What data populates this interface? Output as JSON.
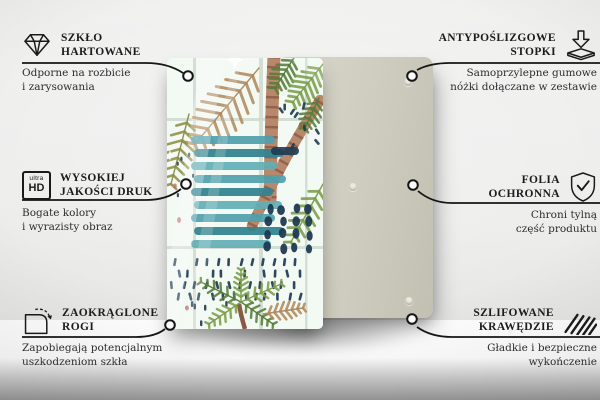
{
  "page": {
    "type": "product-feature-infographic",
    "language": "pl"
  },
  "product": {
    "front_panel": "glass board with tropical watercolor print (palms, teal stripes, navy dots)",
    "back_panel": "plain rear panel with self-adhesive feet"
  },
  "features": [
    {
      "id": "tempered-glass",
      "icon": "diamond-icon",
      "side": "top-left",
      "title_lines": [
        "SZKŁO",
        "HARTOWANE"
      ],
      "desc_lines": [
        "Odporne na rozbicie",
        "i zarysowania"
      ]
    },
    {
      "id": "anti-slip-feet",
      "icon": "adhesive-feet-icon",
      "side": "top-right",
      "title_lines": [
        "ANTYPOŚLIZGOWE",
        "STOPKI"
      ],
      "desc_lines": [
        "Samoprzylepne gumowe",
        "nóżki dołączane w zestawie"
      ]
    },
    {
      "id": "high-quality-print",
      "icon": "ultra-hd-icon",
      "side": "middle-left",
      "icon_label_top": "ultra",
      "icon_label_bottom": "HD",
      "title_lines": [
        "WYSOKIEJ",
        "JAKOŚCI DRUK"
      ],
      "desc_lines": [
        "Bogate kolory",
        "i wyrazisty obraz"
      ]
    },
    {
      "id": "protective-film",
      "icon": "shield-check-icon",
      "side": "middle-right",
      "title_lines": [
        "FOLIA",
        "OCHRONNA"
      ],
      "desc_lines": [
        "Chroni tylną",
        "część produktu"
      ]
    },
    {
      "id": "rounded-corners",
      "icon": "rounded-corner-icon",
      "side": "bottom-left",
      "title_lines": [
        "ZAOKRĄGLONE",
        "ROGI"
      ],
      "desc_lines": [
        "Zapobiegają potencjalnym",
        "uszkodzeniom szkła"
      ]
    },
    {
      "id": "polished-edges",
      "icon": "hatched-edge-icon",
      "side": "bottom-right",
      "title_lines": [
        "SZLIFOWANE",
        "KRAWĘDZIE"
      ],
      "desc_lines": [
        "Gładkie i bezpieczne",
        "wykończenie"
      ]
    }
  ],
  "colors": {
    "line": "#161616",
    "back_panel": "#cfcec0",
    "teal1": "#4FA0AC",
    "teal2": "#2F818F",
    "teal3": "#62AFB5",
    "navy": "#1d3a52",
    "trunk": "#b9886c",
    "trunk_dark": "#8a5a44",
    "green": "#7ba04a",
    "green_dark": "#567f3a",
    "tan": "#b28a5e",
    "olive": "#8f9048",
    "grid": "#ccd9cf",
    "red_speck": "#c46a6a"
  }
}
